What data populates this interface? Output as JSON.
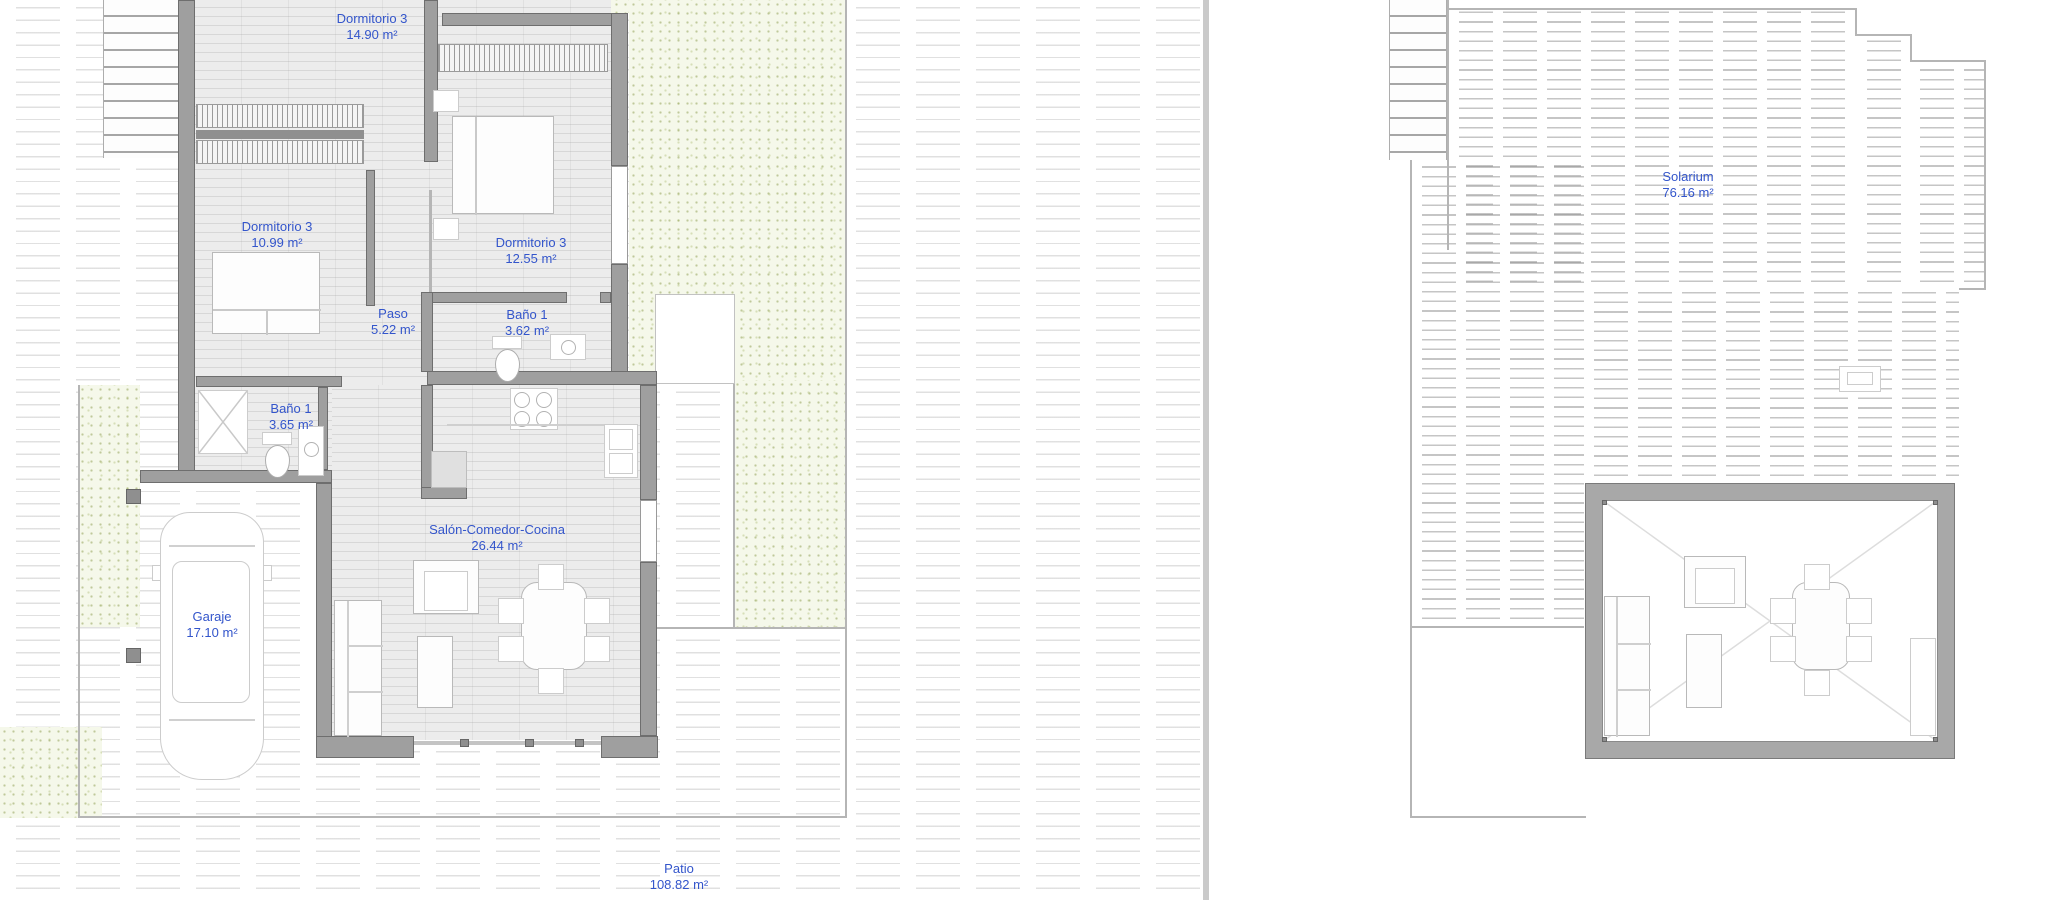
{
  "document": {
    "type": "architectural floor plan",
    "language": "Spanish",
    "panels": 2
  },
  "colors": {
    "label_text": "#3355cb",
    "wall_fill": "#9f9f9f",
    "garden_fill": "#f5f8ea",
    "floor_fill": "#ececec",
    "hatch_line": "#8c8c8c"
  },
  "left_plan": {
    "rooms": [
      {
        "id": "dormitorio3-top",
        "label": "Dormitorio 3",
        "area": "14.90 m²"
      },
      {
        "id": "dormitorio3-left",
        "label": "Dormitorio 3",
        "area": "10.99 m²"
      },
      {
        "id": "dormitorio3-right",
        "label": "Dormitorio 3",
        "area": "12.55 m²"
      },
      {
        "id": "paso",
        "label": "Paso",
        "area": "5.22 m²"
      },
      {
        "id": "bano1-right",
        "label": "Baño 1",
        "area": "3.62 m²"
      },
      {
        "id": "bano1-left",
        "label": "Baño 1",
        "area": "3.65 m²"
      },
      {
        "id": "salon",
        "label": "Salón-Comedor-Cocina",
        "area": "26.44 m²"
      },
      {
        "id": "garaje",
        "label": "Garaje",
        "area": "17.10 m²"
      },
      {
        "id": "patio",
        "label": "Patio",
        "area": "108.82 m²"
      }
    ]
  },
  "right_plan": {
    "rooms": [
      {
        "id": "solarium",
        "label": "Solarium",
        "area": "76.16 m²"
      }
    ]
  }
}
